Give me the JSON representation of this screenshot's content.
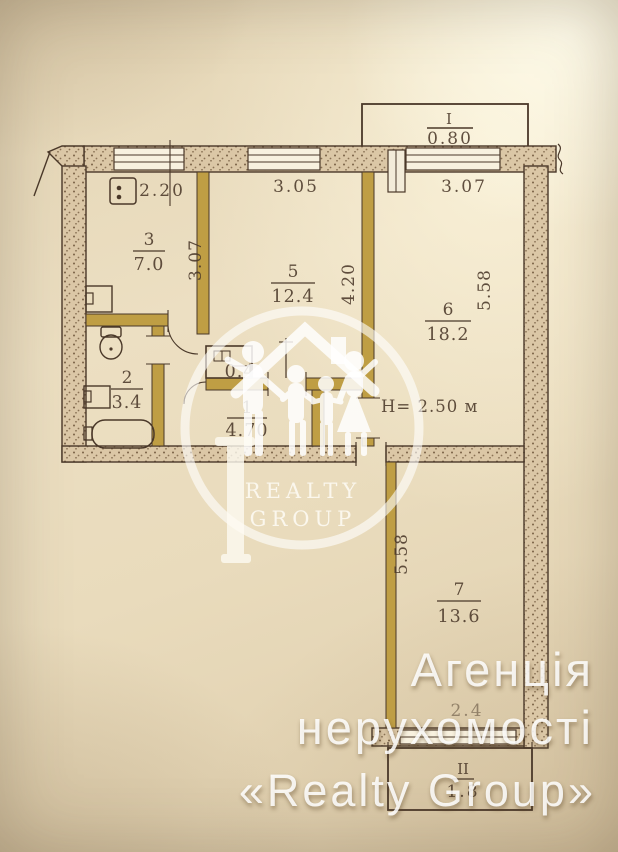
{
  "plan": {
    "labels": {
      "kitchen_no": "3",
      "kitchen_area": "7.0",
      "room5_no": "5",
      "room5_area": "12.4",
      "room6_no": "6",
      "room6_area": "18.2",
      "bath_no": "2",
      "bath_area": "3.4",
      "hall_no": "1",
      "hall_area": "4.70",
      "room7_no": "7",
      "room7_area": "13.6",
      "closet_area": "0.4",
      "balcony1_no": "I",
      "balcony1_area": "0.80",
      "balcony2_no": "II",
      "balcony2_area": "1.8",
      "height": "H= 2.50 м"
    },
    "dims": {
      "kitchen_w": "2.20",
      "room5_w": "3.05",
      "room6_w": "3.07",
      "kitchen_d": "3.07",
      "room5_d": "4.20",
      "room6_d": "5.58",
      "room7_d": "5.58",
      "balcony2_w": "2.4"
    },
    "palette": {
      "ink": "#4a3829",
      "partition_wall": "#bf9e44",
      "masonry_wall": "#dbc7a6",
      "paper": "#ecdfc2",
      "watermark": "#ffffff"
    }
  },
  "watermark": {
    "logo_line1": "REALTY",
    "logo_line2": "GROUP",
    "agency_line1": "Агенція",
    "agency_line2": "нерухомості",
    "agency_line3": "«Realty Group»"
  }
}
